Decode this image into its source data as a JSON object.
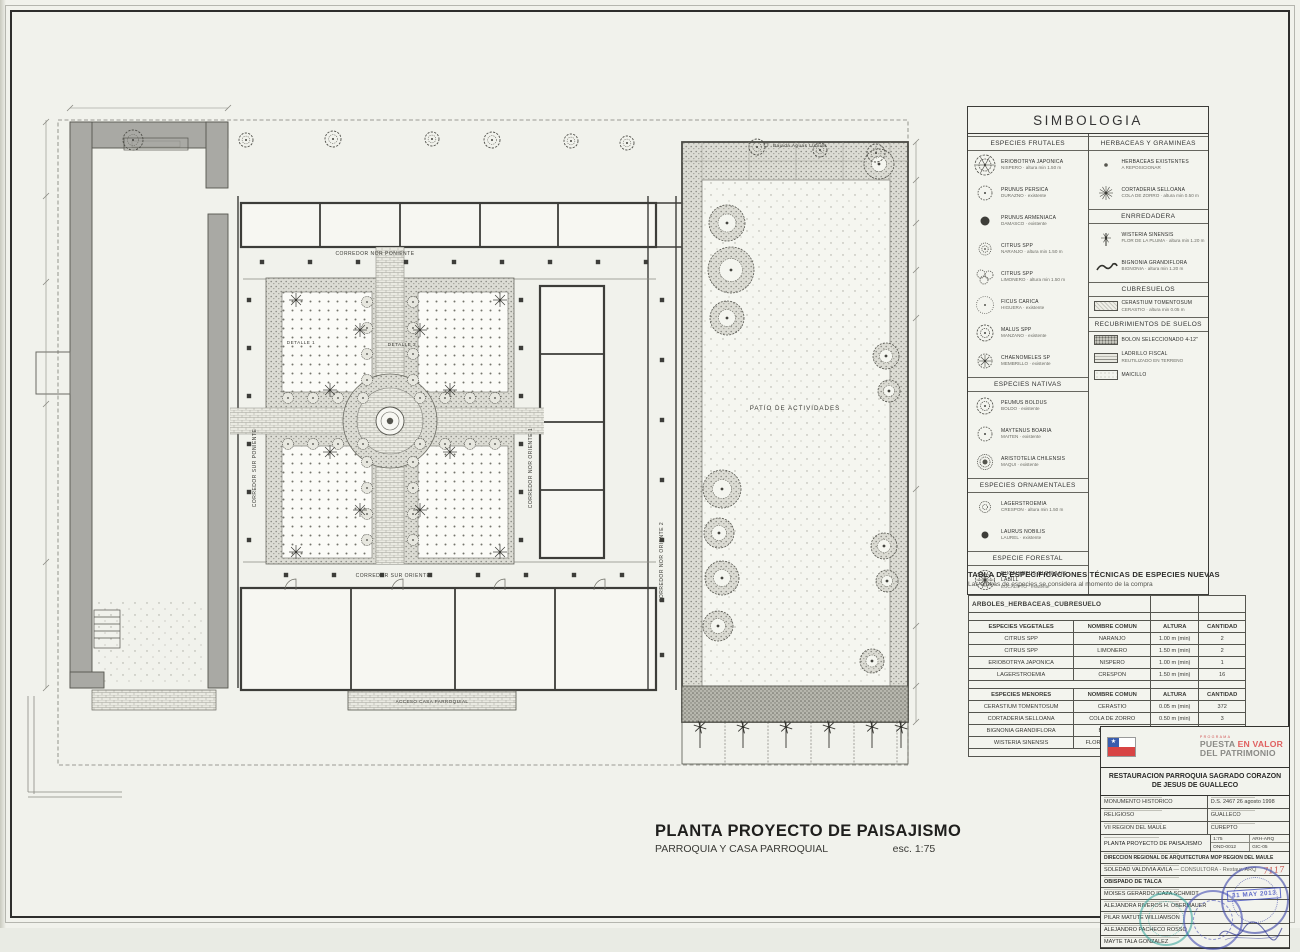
{
  "sheet": {
    "plan_title": "PLANTA PROYECTO DE PAISAJISMO",
    "plan_subtitle": "PARROQUIA Y CASA PARROQUIAL",
    "plan_scale": "esc. 1:75"
  },
  "plan_labels": {
    "corredor_nor_poniente": "CORREDOR NOR PONIENTE",
    "corredor_sur_poniente": "CORREDOR SUR PONIENTE",
    "corredor_nor_oriente_1": "CORREDOR NOR ORIENTE 1",
    "corredor_nor_oriente_2": "CORREDOR NOR ORIENTE 2",
    "corredor_sur_oriente": "CORREDOR SUR ORIENTE",
    "patio": "PATIO DE ACTIVIDADES",
    "detalle_1": "DETALLE 1",
    "detalle_2": "DETALLE 2",
    "acceso": "ACCESO CASA PARROQUIAL",
    "bajada_aguas": "Bajada Aguas Lluvias"
  },
  "simbologia": {
    "title": "SIMBOLOGIA",
    "left_sections": [
      {
        "title": "ESPECIES FRUTALES",
        "items": [
          {
            "icon": "tree-xl",
            "name": "ERIOBOTRYA JAPONICA",
            "sub": "NISPERO · altura min 1.50 m"
          },
          {
            "icon": "tree-scallop",
            "name": "PRUNUS PERSICA",
            "sub": "DURAZNO · existente"
          },
          {
            "icon": "dot-dark",
            "name": "PRUNUS ARMENIACA",
            "sub": "DAMASCO · existente"
          },
          {
            "icon": "tree-swirl",
            "name": "CITRUS SPP",
            "sub": "NARANJO · altura min 1.50 m"
          },
          {
            "icon": "tree-cluster",
            "name": "CITRUS SPP",
            "sub": "LIMONERO · altura min 1.50 m"
          },
          {
            "icon": "tree-light",
            "name": "FICUS CARICA",
            "sub": "HIGUERA · existente"
          },
          {
            "icon": "tree-fluffy",
            "name": "MALUS SPP",
            "sub": "MANZANO · existente"
          },
          {
            "icon": "tree-star",
            "name": "CHAENOMELES SP",
            "sub": "MEMBRILLO · existente"
          }
        ]
      },
      {
        "title": "ESPECIES NATIVAS",
        "items": [
          {
            "icon": "tree-fluffy",
            "name": "PEUMUS BOLDUS",
            "sub": "BOLDO · existente"
          },
          {
            "icon": "tree-scallop",
            "name": "MAYTENUS BOARIA",
            "sub": "MAITEN · existente"
          },
          {
            "icon": "tree-dense",
            "name": "ARISTOTELIA CHILENSIS",
            "sub": "MAQUI · existente"
          }
        ]
      },
      {
        "title": "ESPECIES ORNAMENTALES",
        "items": [
          {
            "icon": "shrub-ring",
            "name": "LAGERSTROEMIA",
            "sub": "CRESPON · altura min 1.50 m"
          },
          {
            "icon": "dot-laurel",
            "name": "LAURUS NOBILIS",
            "sub": "LAUREL · existente"
          }
        ]
      },
      {
        "title": "ESPECIE FORESTAL",
        "items": [
          {
            "icon": "tree-euca",
            "name": "EUCALYPTUS GLOBULUS LABILL",
            "sub": "EUCALIPTO · existente"
          }
        ]
      }
    ],
    "right_sections": [
      {
        "title": "HERBACEAS Y GRAMINEAS",
        "items": [
          {
            "icon": "dot-herb",
            "name": "HERBACEAS EXISTENTES",
            "sub": "A REPOSICIONAR"
          },
          {
            "icon": "grass",
            "name": "CORTADERIA SELLOANA",
            "sub": "COLA DE ZORRO · altura min 0.50 m"
          }
        ]
      },
      {
        "title": "ENRREDADERA",
        "items": [
          {
            "icon": "vine1",
            "name": "WISTERIA SINENSIS",
            "sub": "FLOR DE LA PLUMA · altura min 1.20 m"
          },
          {
            "icon": "vine2",
            "name": "BIGNONIA GRANDIFLORA",
            "sub": "BIGNONIA · altura min 1.20 m"
          }
        ]
      },
      {
        "title": "CUBRESUELOS",
        "items": [
          {
            "icon": "sw-cerastio",
            "name": "CERASTIUM TOMENTOSUM",
            "sub": "CERASTIO · altura min 0.05 m"
          }
        ]
      },
      {
        "title": "RECUBRIMIENTOS DE SUELOS",
        "items": [
          {
            "icon": "sw-bolon",
            "name": "BOLON SELECCIONADO 4-12\"",
            "sub": ""
          },
          {
            "icon": "sw-ladrillo",
            "name": "LADRILLO FISCAL",
            "sub": "REUTILIZADO EN TERRENO"
          },
          {
            "icon": "sw-maicillo",
            "name": "MAICILLO",
            "sub": ""
          }
        ]
      }
    ]
  },
  "spec_table": {
    "title": "TABLA DE ESPECIFICACIONES TÉCNICAS  DE ESPECIES NUEVAS",
    "subtitle": "Las alturas de especies se considera al momento de la compra",
    "group_header": "ARBOLES_HERBACEAS_CUBRESUELO",
    "sections": [
      {
        "headers": [
          "ESPECIES VEGETALES",
          "NOMBRE COMUN",
          "ALTURA",
          "CANTIDAD"
        ],
        "rows": [
          [
            "CITRUS SPP",
            "NARANJO",
            "1.00 m (min)",
            "2"
          ],
          [
            "CITRUS SPP",
            "LIMONERO",
            "1.50 m (min)",
            "2"
          ],
          [
            "ERIOBOTRYA JAPONICA",
            "NISPERO",
            "1.00 m (min)",
            "1"
          ],
          [
            "LAGERSTROEMIA",
            "CRESPON",
            "1.50 m (min)",
            "16"
          ]
        ]
      },
      {
        "headers": [
          "ESPECIES MENORES",
          "NOMBRE COMUN",
          "ALTURA",
          "CANTIDAD"
        ],
        "rows": [
          [
            "CERASTIUM TOMENTOSUM",
            "CERASTIO",
            "0.05 m (min)",
            "372"
          ],
          [
            "CORTADERIA SELLOANA",
            "COLA DE ZORRO",
            "0.50 m (min)",
            "3"
          ],
          [
            "BIGNONIA GRANDIFLORA",
            "BIGNONIA",
            "1.20 m (min)",
            "7"
          ],
          [
            "WISTERIA SINENSIS",
            "FLOR DE LA PLUMA",
            "1.20 m (min)",
            "7"
          ]
        ]
      }
    ]
  },
  "title_block": {
    "program_small": "PROGRAMA",
    "program_word1": "PUESTA ",
    "program_word2": "EN VALOR",
    "program_line2": "DEL PATRIMONIO",
    "project_title": "RESTAURACION PARROQUIA SAGRADO CORAZON DE JESUS DE GUALLECO",
    "rows": [
      {
        "left": "MONUMENTO HISTORICO",
        "right": "D.S. 2467  26 agosto 1998"
      },
      {
        "left": "RELIGIOSO",
        "right": "GUALLECO"
      },
      {
        "left": "VII REGION DEL MAULE",
        "right": "CUREPTO"
      }
    ],
    "plan_row": {
      "name": "PLANTA PROYECTO DE PAISAJISMO",
      "scale": "1:75",
      "code1": "ARH-ARQ",
      "code2": "OND-0012",
      "code3": "GIC-05"
    },
    "mandante": "DIRECCION REGIONAL DE ARQUITECTURA MOP REGION DEL MAULE",
    "consultora": "SOLEDAD VALDIVIA AVILA",
    "consultora_suffix": " — CONSULTORA - Restaur. ARQ",
    "handwritten": "7117",
    "owner": "OBISPADO DE TALCA",
    "signers": [
      "MOISES GERARDO ICAZA SCHMIDT",
      "ALEJANDRA RIVEROS H. OBERMAUER",
      "PILAR MATUTE WILLIAMSON",
      "ALEJANDRO PACHECO ROSSO",
      "MAYTE TALA GONZALEZ"
    ],
    "date_stamp": "31 MAY 2013"
  },
  "colors": {
    "accent_red": "#d84444",
    "stamp_blue": "#3f48a8",
    "stamp_teal": "#1f9c92",
    "wall_gray": "#a9a9a4"
  }
}
